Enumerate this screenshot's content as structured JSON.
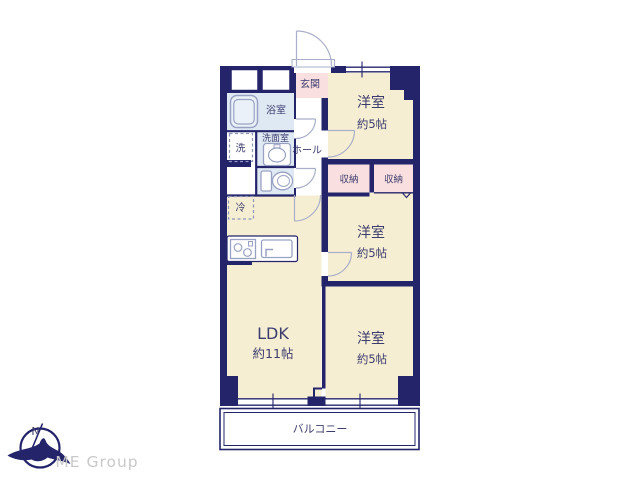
{
  "colors": {
    "wall": "#24246b",
    "cream": "#f6eed3",
    "pink": "#f9dfdf",
    "blue": "#dfe9f3",
    "ink": "#3c3c6e",
    "fixture": "#9aa2c4",
    "arc": "#a9afc9",
    "dash": "#8d96bb",
    "logo_gray": "#c9c9c9"
  },
  "rooms": {
    "entrance": {
      "label": "玄関"
    },
    "bathroom": {
      "label": "浴室"
    },
    "laundry": {
      "label": "洗"
    },
    "washroom": {
      "label": "洗面室"
    },
    "hall": {
      "label": "ホール"
    },
    "refrigerator": {
      "label": "冷"
    },
    "closet_a": {
      "label": "収納"
    },
    "closet_b": {
      "label": "収納"
    },
    "bedroom_top": {
      "label": "洋室",
      "size": "約5帖"
    },
    "bedroom_mid": {
      "label": "洋室",
      "size": "約5帖"
    },
    "bedroom_bottom": {
      "label": "洋室",
      "size": "約5帖"
    },
    "ldk": {
      "label": "LDK",
      "size": "約11帖"
    },
    "balcony": {
      "label": "バルコニー"
    }
  },
  "branding": {
    "company": "ME Group",
    "compass_north": "N"
  }
}
